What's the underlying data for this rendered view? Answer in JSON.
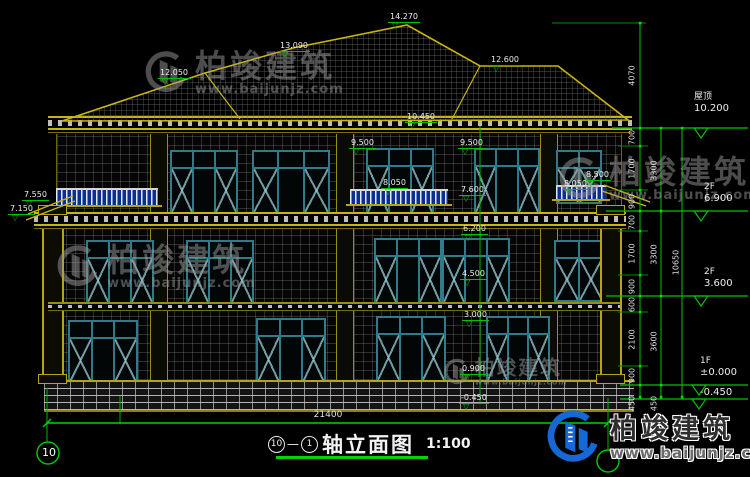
{
  "drawing": {
    "title": "轴立面图",
    "scale_label": "1:100",
    "axis_from": "10",
    "axis_dash": "—",
    "axis_to": "1",
    "axis_bubble_left": "10"
  },
  "dims": {
    "bottom_total": "21400",
    "right_top": "4070",
    "right_inner": [
      "700",
      "1700",
      "900",
      "700",
      "1700",
      "900",
      "600",
      "2100",
      "900",
      "450"
    ],
    "right_middle": [
      "3300",
      "3300",
      "3600",
      "450"
    ],
    "right_outer": "10650"
  },
  "levels": [
    {
      "label": "屋顶",
      "value": "10.200"
    },
    {
      "label": "2F",
      "value": "6.900"
    },
    {
      "label": "2F",
      "value": "3.600"
    },
    {
      "label": "1F",
      "value": "±0.000"
    },
    {
      "label": "",
      "value": "-0.450"
    }
  ],
  "markers": [
    {
      "value": "14.270"
    },
    {
      "value": "13.090"
    },
    {
      "value": "12.050"
    },
    {
      "value": "12.600"
    },
    {
      "value": "10.450"
    },
    {
      "value": "9.500"
    },
    {
      "value": "9.500"
    },
    {
      "value": "8.050"
    },
    {
      "value": "7.600"
    },
    {
      "value": "8.500"
    },
    {
      "value": "8.050"
    },
    {
      "value": "7.550"
    },
    {
      "value": "7.150"
    },
    {
      "value": "6.200"
    },
    {
      "value": "4.500"
    },
    {
      "value": "3.000"
    },
    {
      "value": "0.900"
    },
    {
      "value": "-0.450"
    }
  ],
  "watermark": {
    "name": "柏竣建筑",
    "url": "www.baijunjz.com"
  },
  "logo": {
    "name": "柏竣建筑",
    "url": "www.baijunjz.com"
  }
}
